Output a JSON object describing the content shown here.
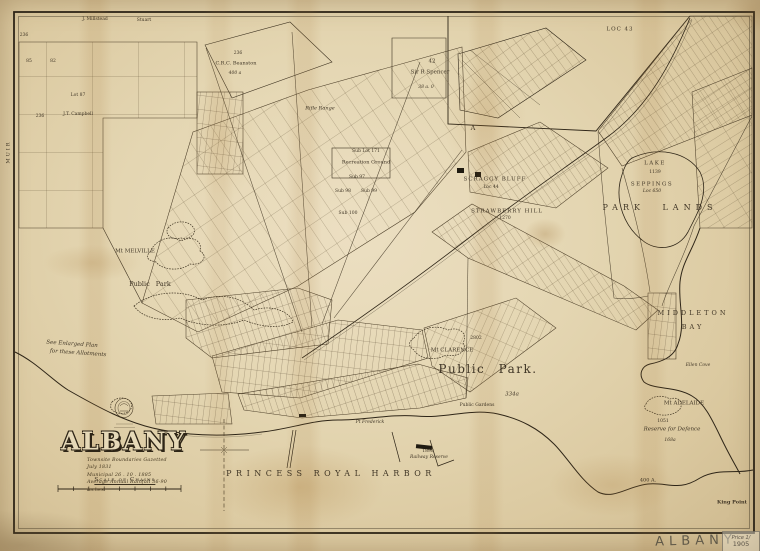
{
  "title_block": {
    "title": "ALBANY",
    "subtitle_lines": [
      "Townsite Boundaries Gazetted July 1831",
      "Municipal   26 . 10 . 1885",
      "Average Annual Rainfall  36·90 inches"
    ],
    "scale_label": "Scale of Chains"
  },
  "marginalia": {
    "sheet_name": "ALBANY",
    "price_note": "Price 1/",
    "year_note": "1905"
  },
  "colors": {
    "paper": "#e4d6b2",
    "ink": "#2e2517",
    "stain": "#a57b3c"
  },
  "map": {
    "region_labels": [
      {
        "text": "PRINCESS ROYAL HARBOR",
        "x": 331,
        "y": 474,
        "s": 8,
        "ls": 4.5
      },
      {
        "text": "Public Park.",
        "x": 488,
        "y": 369,
        "s": 12,
        "ls": 1.5,
        "ws": 8
      },
      {
        "text": "PARK LANDS",
        "x": 660,
        "y": 208,
        "s": 8,
        "ls": 5,
        "ws": 10
      },
      {
        "text": "MIDDLETON",
        "x": 693,
        "y": 313,
        "s": 6.5,
        "ls": 3
      },
      {
        "text": "BAY",
        "x": 693,
        "y": 327,
        "s": 6.5,
        "ls": 3
      },
      {
        "text": "Mt MELVILLE",
        "x": 135,
        "y": 252,
        "s": 5.5
      },
      {
        "text": "Public Park",
        "x": 150,
        "y": 284,
        "s": 6.5,
        "ws": 4
      },
      {
        "text": "Mt CLARENCE",
        "x": 452,
        "y": 351,
        "s": 5.5
      },
      {
        "text": "2802",
        "x": 476,
        "y": 339,
        "s": 4.5
      },
      {
        "text": "334a",
        "x": 512,
        "y": 395,
        "s": 5.5,
        "i": true
      },
      {
        "text": "LAKE",
        "x": 655,
        "y": 164,
        "s": 5.5,
        "ls": 1.5
      },
      {
        "text": "1139",
        "x": 655,
        "y": 173,
        "s": 4.5
      },
      {
        "text": "SEPPINGS",
        "x": 652,
        "y": 185,
        "s": 5.5,
        "ls": 1.5
      },
      {
        "text": "Loc 650",
        "x": 652,
        "y": 192,
        "s": 4.5,
        "i": true
      },
      {
        "text": "Mt ADELAIDE",
        "x": 684,
        "y": 404,
        "s": 5.5
      },
      {
        "text": "1051",
        "x": 663,
        "y": 422,
        "s": 4.5
      },
      {
        "text": "Reserve for Defence",
        "x": 672,
        "y": 430,
        "s": 5.5,
        "i": true
      },
      {
        "text": "168a",
        "x": 670,
        "y": 441,
        "s": 4.5,
        "i": true
      },
      {
        "text": "King Point",
        "x": 732,
        "y": 503,
        "s": 5,
        "b": true
      },
      {
        "text": "400 A.",
        "x": 648,
        "y": 481,
        "s": 5
      },
      {
        "text": "Ellen Cove",
        "x": 698,
        "y": 366,
        "s": 4.5,
        "i": true
      },
      {
        "text": "Rifle Range",
        "x": 320,
        "y": 109,
        "s": 5,
        "i": true
      },
      {
        "text": "236",
        "x": 238,
        "y": 54,
        "s": 4.5
      },
      {
        "text": "C.R.C. Beanston",
        "x": 236,
        "y": 64,
        "s": 5
      },
      {
        "text": "400 a",
        "x": 235,
        "y": 74,
        "s": 4.5,
        "i": true
      },
      {
        "text": "Sub Lot 171",
        "x": 366,
        "y": 152,
        "s": 4.5
      },
      {
        "text": "Recreation Ground",
        "x": 366,
        "y": 163,
        "s": 5
      },
      {
        "text": "Sub 97",
        "x": 357,
        "y": 178,
        "s": 4.5
      },
      {
        "text": "Sub 98",
        "x": 343,
        "y": 192,
        "s": 4.5
      },
      {
        "text": "Sub 99",
        "x": 369,
        "y": 192,
        "s": 4.5
      },
      {
        "text": "Sub 100",
        "x": 348,
        "y": 214,
        "s": 4.5
      },
      {
        "text": "SCRAGGY BLUFF",
        "x": 495,
        "y": 180,
        "s": 5.5,
        "ls": 1
      },
      {
        "text": "Loc 44",
        "x": 491,
        "y": 188,
        "s": 4.5
      },
      {
        "text": "STRAWBERRY HILL",
        "x": 507,
        "y": 212,
        "s": 5.5,
        "ls": 1
      },
      {
        "text": "1270",
        "x": 505,
        "y": 219,
        "s": 4.5
      },
      {
        "text": "42",
        "x": 432,
        "y": 62,
        "s": 5.5
      },
      {
        "text": "Sir R Spencer",
        "x": 430,
        "y": 73,
        "s": 5.5
      },
      {
        "text": "38 a. 0",
        "x": 426,
        "y": 88,
        "s": 4.5,
        "i": true
      },
      {
        "text": "LOC 43",
        "x": 620,
        "y": 30,
        "s": 5.5,
        "ls": 1
      },
      {
        "text": "A",
        "x": 473,
        "y": 128,
        "s": 6.5
      },
      {
        "text": "J. Millstead",
        "x": 95,
        "y": 20,
        "s": 4.5
      },
      {
        "text": "Stuart",
        "x": 144,
        "y": 21,
        "s": 4.5
      },
      {
        "text": "236",
        "x": 24,
        "y": 36,
        "s": 4.5
      },
      {
        "text": "85",
        "x": 29,
        "y": 62,
        "s": 4.5
      },
      {
        "text": "82",
        "x": 53,
        "y": 62,
        "s": 4.5
      },
      {
        "text": "Lot 87",
        "x": 78,
        "y": 96,
        "s": 4.5
      },
      {
        "text": "J.T. Campbell",
        "x": 78,
        "y": 115,
        "s": 4.5
      },
      {
        "text": "236",
        "x": 40,
        "y": 117,
        "s": 4.5
      },
      {
        "text": "MUIR",
        "x": 9,
        "y": 152,
        "s": 5,
        "r": -90,
        "ls": 2
      },
      {
        "text": "See Enlarged Plan",
        "x": 72,
        "y": 345,
        "s": 5.5,
        "i": true,
        "r": 4
      },
      {
        "text": "for these Allotments",
        "x": 78,
        "y": 354,
        "s": 5.5,
        "i": true,
        "r": 4
      },
      {
        "text": "Pt Frederick",
        "x": 370,
        "y": 423,
        "s": 4.5,
        "i": true
      },
      {
        "text": "Public Gardens",
        "x": 477,
        "y": 406,
        "s": 4.5
      },
      {
        "text": "1898",
        "x": 428,
        "y": 452,
        "s": 4.5
      },
      {
        "text": "Railway Reserve",
        "x": 429,
        "y": 458,
        "s": 4.5,
        "i": true
      }
    ]
  }
}
